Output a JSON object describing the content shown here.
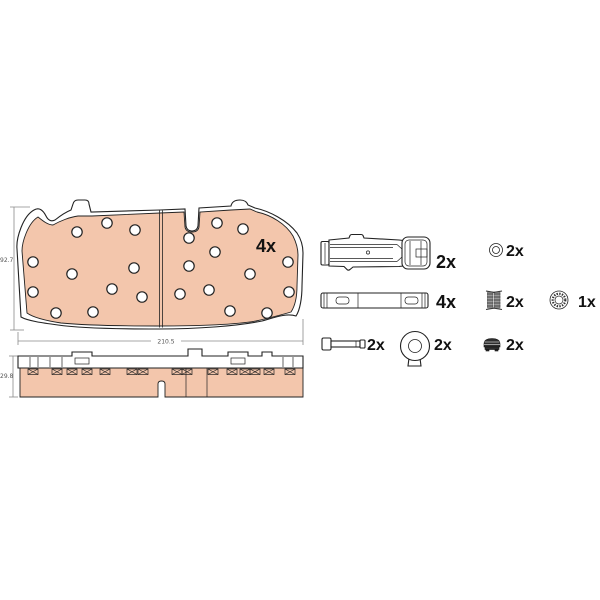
{
  "front_view": {
    "qty": "4x",
    "width": "210.5",
    "height": "92.7"
  },
  "side_view": {
    "thickness": "29.8"
  },
  "parts": {
    "retaining_spring": {
      "name": "pad-retaining-spring",
      "qty": "2x"
    },
    "washer": {
      "name": "washer-ring",
      "qty": "2x"
    },
    "guide_bar": {
      "name": "guide-bar-plate",
      "qty": "4x"
    },
    "spring_pair": {
      "name": "coil-spring-pair",
      "qty": "2x"
    },
    "cap_ring": {
      "name": "serrated-cap-ring",
      "qty": "1x"
    },
    "pin_bolt": {
      "name": "retainer-pin-bolt",
      "qty": "2x"
    },
    "sensor_grommet": {
      "name": "grommet-with-tab",
      "qty": "2x"
    },
    "grease_pack": {
      "name": "grease-pack",
      "qty": "2x"
    }
  },
  "colors": {
    "friction": "#f3c6ac",
    "outline": "#222222",
    "dim": "#8a8a8a",
    "label": "#111111"
  }
}
